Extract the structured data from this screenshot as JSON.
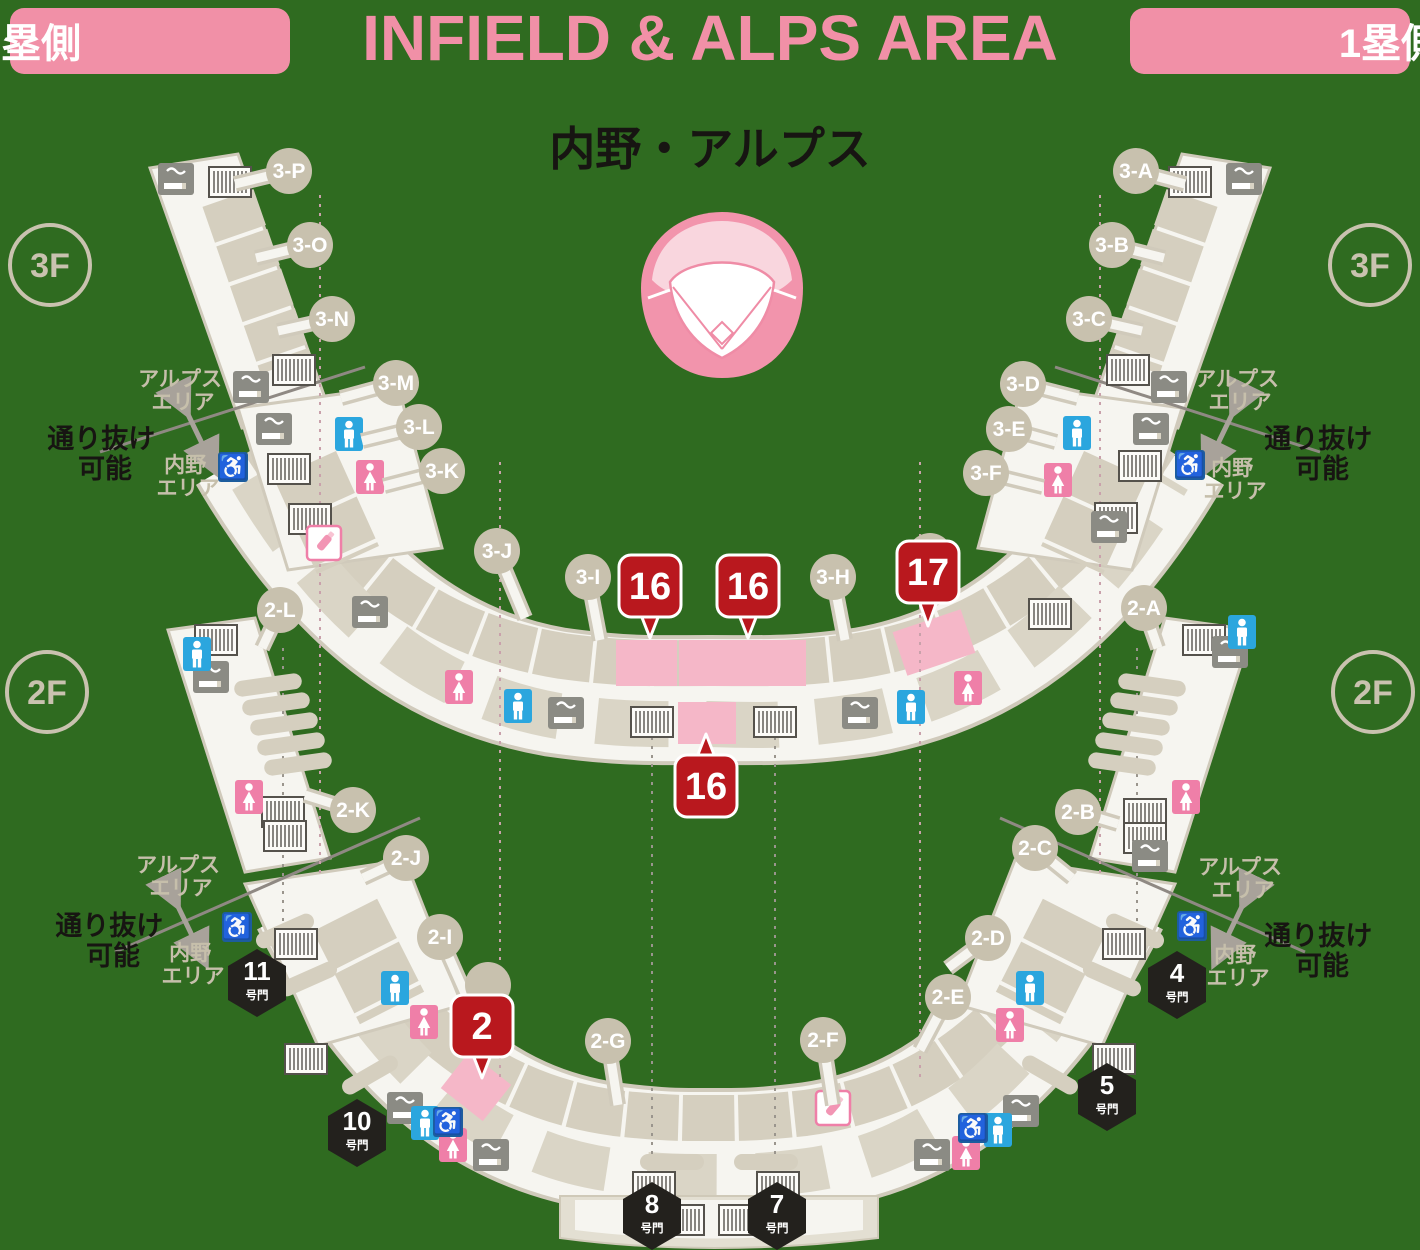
{
  "header": {
    "left_badge": "3塁側",
    "title": "INFIELD & ALPS AREA",
    "right_badge": "1塁側",
    "subtitle": "内野・アルプス"
  },
  "glyphs": {
    "wheelchair": "♿"
  },
  "colors": {
    "background": "#2f6b20",
    "accent_pink": "#f190a7",
    "badge_red": "#b9181e",
    "highlight_pink": "#f5b7c8",
    "beige": "#c8c1ae",
    "band_white": "#f6f5f0",
    "gate_black": "#23211d",
    "toilet_male_blue": "#2ba6de",
    "toilet_female_pink": "#ef7fa8",
    "wheelchair_blue": "#1d5d9e"
  },
  "floors": [
    {
      "label": "3F",
      "x": 50,
      "y": 265
    },
    {
      "label": "3F",
      "x": 1370,
      "y": 265
    },
    {
      "label": "2F",
      "x": 47,
      "y": 692
    },
    {
      "label": "2F",
      "x": 1373,
      "y": 692
    }
  ],
  "sections": [
    {
      "label": "3-P",
      "x": 289,
      "y": 171,
      "sx": 235,
      "sy": 184
    },
    {
      "label": "3-O",
      "x": 310,
      "y": 245,
      "sx": 256,
      "sy": 258
    },
    {
      "label": "3-N",
      "x": 332,
      "y": 319,
      "sx": 278,
      "sy": 331
    },
    {
      "label": "3-M",
      "x": 396,
      "y": 383,
      "sx": 341,
      "sy": 398
    },
    {
      "label": "3-L",
      "x": 419,
      "y": 427,
      "sx": 362,
      "sy": 441
    },
    {
      "label": "3-K",
      "x": 442,
      "y": 471,
      "sx": 384,
      "sy": 486
    },
    {
      "label": "3-J",
      "x": 497,
      "y": 551,
      "sx": 525,
      "sy": 618
    },
    {
      "label": "3-I",
      "x": 588,
      "y": 577,
      "sx": 600,
      "sy": 640
    },
    {
      "label": "3-H",
      "x": 833,
      "y": 577,
      "sx": 845,
      "sy": 640
    },
    {
      "label": "",
      "x": 930,
      "y": 556,
      "sx": 930,
      "sy": 556
    },
    {
      "label": "3-F",
      "x": 986,
      "y": 473,
      "sx": 1043,
      "sy": 487
    },
    {
      "label": "3-E",
      "x": 1009,
      "y": 429,
      "sx": 1056,
      "sy": 442
    },
    {
      "label": "3-D",
      "x": 1023,
      "y": 384,
      "sx": 1078,
      "sy": 398
    },
    {
      "label": "3-C",
      "x": 1089,
      "y": 319,
      "sx": 1142,
      "sy": 331
    },
    {
      "label": "3-B",
      "x": 1112,
      "y": 245,
      "sx": 1164,
      "sy": 258
    },
    {
      "label": "3-A",
      "x": 1136,
      "y": 171,
      "sx": 1185,
      "sy": 184
    },
    {
      "label": "2-L",
      "x": 280,
      "y": 610,
      "sx": 262,
      "sy": 648
    },
    {
      "label": "2-K",
      "x": 353,
      "y": 810,
      "sx": 305,
      "sy": 795
    },
    {
      "label": "2-J",
      "x": 406,
      "y": 858,
      "sx": 363,
      "sy": 878
    },
    {
      "label": "2-I",
      "x": 440,
      "y": 937,
      "sx": 468,
      "sy": 1000
    },
    {
      "label": "",
      "x": 488,
      "y": 985,
      "sx": 488,
      "sy": 985
    },
    {
      "label": "2-G",
      "x": 608,
      "y": 1041,
      "sx": 618,
      "sy": 1105
    },
    {
      "label": "2-F",
      "x": 823,
      "y": 1040,
      "sx": 833,
      "sy": 1105
    },
    {
      "label": "2-E",
      "x": 948,
      "y": 997,
      "sx": 920,
      "sy": 1050
    },
    {
      "label": "2-D",
      "x": 988,
      "y": 938,
      "sx": 948,
      "sy": 968
    },
    {
      "label": "2-C",
      "x": 1035,
      "y": 848,
      "sx": 1072,
      "sy": 878
    },
    {
      "label": "2-B",
      "x": 1078,
      "y": 812,
      "sx": 1118,
      "sy": 824
    },
    {
      "label": "2-A",
      "x": 1144,
      "y": 608,
      "sx": 1158,
      "sy": 648
    }
  ],
  "gates": [
    {
      "num": "11",
      "s": "号門",
      "t": "translate(257,983)"
    },
    {
      "num": "4",
      "s": "号門",
      "t": "translate(1177,985)"
    },
    {
      "num": "10",
      "s": "号門",
      "t": "translate(357,1133)"
    },
    {
      "num": "5",
      "s": "号門",
      "t": "translate(1107,1097)"
    },
    {
      "num": "8",
      "s": "号門",
      "t": "translate(652,1216)"
    },
    {
      "num": "7",
      "s": "号門",
      "t": "translate(777,1216)"
    }
  ],
  "badges": [
    {
      "num": "16",
      "t": "translate(650,586)",
      "tail": "-9,29 9,29 0,52"
    },
    {
      "num": "16",
      "t": "translate(748,586)",
      "tail": "-9,29 9,29 0,52"
    },
    {
      "num": "17",
      "t": "translate(928,572)",
      "tail": "-9,29 9,29 0,54"
    },
    {
      "num": "16",
      "t": "translate(706,786)",
      "tail": "-9,-29 9,-29 0,-52"
    },
    {
      "num": "2",
      "t": "translate(482,1026)",
      "tail": "-9,29 9,29 0,52"
    }
  ],
  "icons": {
    "smoking": [
      {
        "t": "translate(176,179)"
      },
      {
        "t": "translate(251,387)"
      },
      {
        "t": "translate(274,429)"
      },
      {
        "t": "translate(370,612)"
      },
      {
        "t": "translate(566,713)"
      },
      {
        "t": "translate(860,713)"
      },
      {
        "t": "translate(1109,527)"
      },
      {
        "t": "translate(1151,429)"
      },
      {
        "t": "translate(1169,387)"
      },
      {
        "t": "translate(1244,179)"
      },
      {
        "t": "translate(211,677)"
      },
      {
        "t": "translate(1230,652)"
      },
      {
        "t": "translate(1150,856)"
      },
      {
        "t": "translate(405,1108)"
      },
      {
        "t": "translate(1021,1111)"
      },
      {
        "t": "translate(491,1155)"
      },
      {
        "t": "translate(932,1155)"
      }
    ],
    "escalator": [
      {
        "t": "translate(230,182)"
      },
      {
        "t": "translate(294,370)"
      },
      {
        "t": "translate(289,469)"
      },
      {
        "t": "translate(310,519)"
      },
      {
        "t": "translate(652,722)"
      },
      {
        "t": "translate(775,722)"
      },
      {
        "t": "translate(1128,370)"
      },
      {
        "t": "translate(1190,182)"
      },
      {
        "t": "translate(1140,466)"
      },
      {
        "t": "translate(1116,518)"
      },
      {
        "t": "translate(1050,614)"
      },
      {
        "t": "translate(216,640)"
      },
      {
        "t": "translate(283,812)"
      },
      {
        "t": "translate(285,836)"
      },
      {
        "t": "translate(1204,640)"
      },
      {
        "t": "translate(1145,814)"
      },
      {
        "t": "translate(1145,838)"
      },
      {
        "t": "translate(296,944)"
      },
      {
        "t": "translate(306,1059)"
      },
      {
        "t": "translate(1124,944)"
      },
      {
        "t": "translate(1114,1059)"
      },
      {
        "t": "translate(654,1187)"
      },
      {
        "t": "translate(778,1187)"
      },
      {
        "t": "translate(683,1220)"
      },
      {
        "t": "translate(740,1220)"
      }
    ],
    "toilet_male": [
      {
        "t": "translate(349,434)"
      },
      {
        "t": "translate(911,707)"
      },
      {
        "t": "translate(518,706)"
      },
      {
        "t": "translate(1077,433)"
      },
      {
        "t": "translate(197,654)"
      },
      {
        "t": "translate(1242,632)"
      },
      {
        "t": "translate(395,988)"
      },
      {
        "t": "translate(1030,988)"
      },
      {
        "t": "translate(425,1123)"
      },
      {
        "t": "translate(998,1130)"
      }
    ],
    "toilet_female": [
      {
        "t": "translate(370,477)"
      },
      {
        "t": "translate(968,688)"
      },
      {
        "t": "translate(459,687)"
      },
      {
        "t": "translate(1058,480)"
      },
      {
        "t": "translate(249,797)"
      },
      {
        "t": "translate(1186,797)"
      },
      {
        "t": "translate(424,1022)"
      },
      {
        "t": "translate(1010,1025)"
      },
      {
        "t": "translate(453,1145)"
      },
      {
        "t": "translate(966,1153)"
      }
    ],
    "wheelchair": [
      {
        "t": "translate(233,467)"
      },
      {
        "t": "translate(1190,465)"
      },
      {
        "t": "translate(237,927)"
      },
      {
        "t": "translate(1192,926)"
      },
      {
        "t": "translate(448,1122)"
      },
      {
        "t": "translate(973,1128)"
      }
    ],
    "bottle": [
      {
        "t": "translate(324,543)"
      },
      {
        "t": "translate(833,1108)"
      }
    ]
  },
  "pills": [
    {
      "t": "translate(268,685) rotate(-8)",
      "x0": -34,
      "w": 68
    },
    {
      "t": "translate(276,704) rotate(-8)",
      "x0": -34,
      "w": 68
    },
    {
      "t": "translate(284,724) rotate(-8)",
      "x0": -34,
      "w": 68
    },
    {
      "t": "translate(291,744) rotate(-8)",
      "x0": -34,
      "w": 68
    },
    {
      "t": "translate(298,764) rotate(-8)",
      "x0": -34,
      "w": 68
    },
    {
      "t": "translate(1152,685) rotate(8)",
      "x0": -34,
      "w": 68
    },
    {
      "t": "translate(1144,704) rotate(8)",
      "x0": -34,
      "w": 68
    },
    {
      "t": "translate(1136,724) rotate(8)",
      "x0": -34,
      "w": 68
    },
    {
      "t": "translate(1129,744) rotate(8)",
      "x0": -34,
      "w": 68
    },
    {
      "t": "translate(1122,764) rotate(8)",
      "x0": -34,
      "w": 68
    },
    {
      "t": "translate(285,931) rotate(-24)",
      "x0": -31,
      "w": 62
    },
    {
      "t": "translate(308,979) rotate(-24)",
      "x0": -31,
      "w": 62
    },
    {
      "t": "translate(370,1075) rotate(-30)",
      "x0": -31,
      "w": 62
    },
    {
      "t": "translate(1135,931) rotate(24)",
      "x0": -31,
      "w": 62
    },
    {
      "t": "translate(1112,979) rotate(24)",
      "x0": -31,
      "w": 62
    },
    {
      "t": "translate(1050,1075) rotate(30)",
      "x0": -31,
      "w": 62
    },
    {
      "t": "translate(672,1162)",
      "x0": -32,
      "w": 64
    },
    {
      "t": "translate(766,1162)",
      "x0": -32,
      "w": 64
    }
  ],
  "area_notes": [
    {
      "line1": "アルプス",
      "line2": "エリア",
      "x": 183,
      "y": 386,
      "y2": 409
    },
    {
      "line1": "内野",
      "line2": "エリア",
      "x": 188,
      "y": 472,
      "y2": 495
    },
    {
      "line1": "アルプス",
      "line2": "エリア",
      "x": 1240,
      "y": 386,
      "y2": 409
    },
    {
      "line1": "内野",
      "line2": "エリア",
      "x": 1235,
      "y": 475,
      "y2": 498
    },
    {
      "line1": "アルプス",
      "line2": "エリア",
      "x": 181,
      "y": 872,
      "y2": 895
    },
    {
      "line1": "内野",
      "line2": "エリア",
      "x": 193,
      "y": 960,
      "y2": 983
    },
    {
      "line1": "アルプス",
      "line2": "エリア",
      "x": 1243,
      "y": 874,
      "y2": 897
    },
    {
      "line1": "内野",
      "line2": "エリア",
      "x": 1238,
      "y": 962,
      "y2": 985
    }
  ],
  "pass_notes": [
    {
      "line1": "通り抜け",
      "line2": "可能",
      "x": 105,
      "y": 448,
      "y2": 478
    },
    {
      "line1": "通り抜け",
      "line2": "可能",
      "x": 1322,
      "y": 448,
      "y2": 478
    },
    {
      "line1": "通り抜け",
      "line2": "可能",
      "x": 113,
      "y": 935,
      "y2": 965
    },
    {
      "line1": "通り抜け",
      "line2": "可能",
      "x": 1322,
      "y": 945,
      "y2": 975
    }
  ],
  "dashes": [
    {
      "x1": 320,
      "y1": 195,
      "x2": 320,
      "y2": 875,
      "c": "#c9a1ab"
    },
    {
      "x1": 500,
      "y1": 462,
      "x2": 500,
      "y2": 1080,
      "c": "#c9a1ab"
    },
    {
      "x1": 920,
      "y1": 462,
      "x2": 920,
      "y2": 1080,
      "c": "#c9a1ab"
    },
    {
      "x1": 1100,
      "y1": 195,
      "x2": 1100,
      "y2": 875,
      "c": "#c9a1ab"
    },
    {
      "x1": 652,
      "y1": 737,
      "x2": 652,
      "y2": 1160,
      "c": "#9a958d"
    },
    {
      "x1": 775,
      "y1": 737,
      "x2": 775,
      "y2": 1160,
      "c": "#9a958d"
    },
    {
      "x1": 283,
      "y1": 648,
      "x2": 283,
      "y2": 928,
      "c": "#9a958d"
    },
    {
      "x1": 1137,
      "y1": 648,
      "x2": 1137,
      "y2": 928,
      "c": "#9a958d"
    }
  ]
}
